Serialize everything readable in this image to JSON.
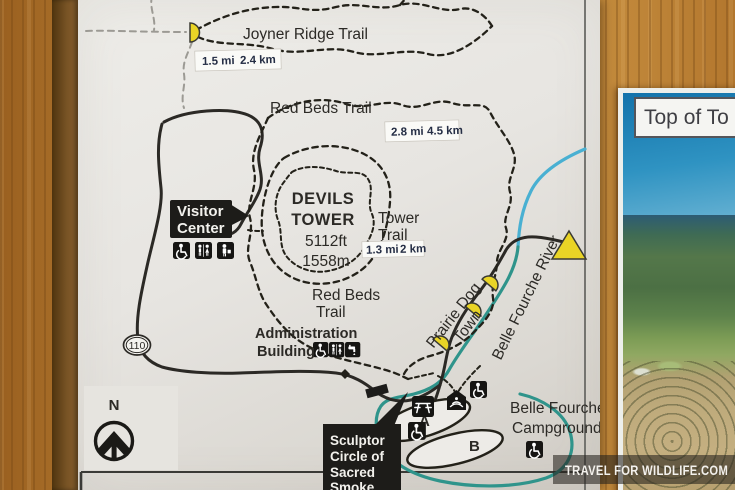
{
  "photo": {
    "watermark": "TRAVEL FOR WILDLIFE.COM"
  },
  "poster": {
    "title": "Top of To"
  },
  "map": {
    "north_label": "N",
    "route_shield": "110",
    "joyner": {
      "name": "Joyner Ridge Trail",
      "mi": "1.5 mi",
      "km": "2.4 km"
    },
    "red_beds": {
      "name": "Red Beds Trail",
      "mi": "2.8 mi",
      "km": "4.5 km",
      "label2_line1": "Red Beds",
      "label2_line2": "Trail"
    },
    "tower_trail": {
      "line1": "Tower",
      "line2": "Trail",
      "mi": "1.3 mi",
      "km": "2 km"
    },
    "devils_tower": {
      "line1": "DEVILS",
      "line2": "TOWER",
      "elevation_ft": "5112ft",
      "elevation_m": "1558m"
    },
    "visitor_center": {
      "line1": "Visitor",
      "line2": "Center",
      "icons": [
        "wheelchair-accessible",
        "restrooms",
        "information"
      ]
    },
    "administration": {
      "line1": "Administration",
      "line2": "Building",
      "icons": [
        "wheelchair-accessible",
        "restrooms",
        "drinking-water"
      ]
    },
    "prairie_dog_town": {
      "line1": "Prairie Dog",
      "line2": "Town"
    },
    "river_label": "Belle Fourche River",
    "campground": {
      "line1": "Belle Fourche",
      "line2": "Campground",
      "loop_a": "A",
      "loop_b": "B"
    },
    "sculptor": {
      "line1": "Sculptor",
      "line2": "Circle of",
      "line3": "Sacred",
      "line4": "Smoke"
    }
  },
  "colors": {
    "river_upper": "#49b0d2",
    "river_lower": "#2f948b",
    "marker_yellow": "#e9d426",
    "road": "#2b2925",
    "callout_bg": "#1d1c19",
    "wood": "#b2722a",
    "paper": "#e8e6e2",
    "poster_sky": "#1373ab"
  }
}
